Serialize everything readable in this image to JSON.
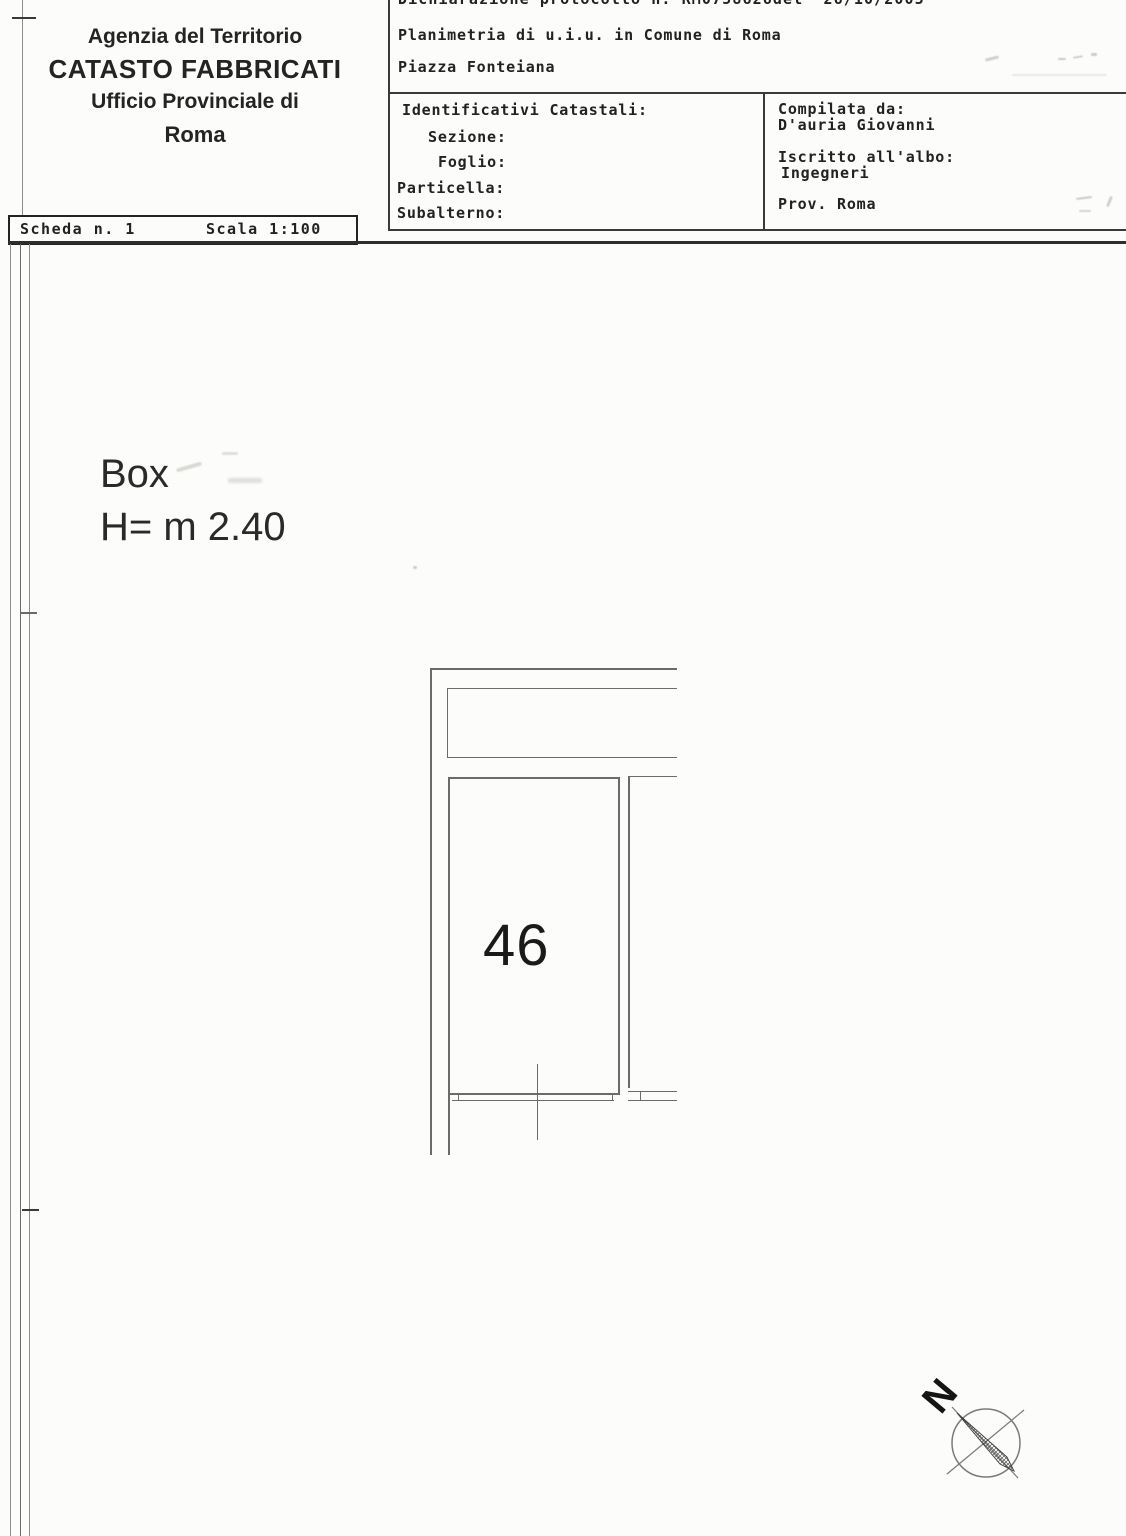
{
  "agency": {
    "line1": "Agenzia del Territorio",
    "line2": "CATASTO FABBRICATI",
    "line3": "Ufficio Provinciale di",
    "line4": "Roma"
  },
  "header": {
    "protocol": "Dichiarazione protocollo n. RM0758626del  26/10/2005",
    "planimetria": "Planimetria di u.i.u. in Comune di Roma",
    "address": "Piazza Fonteiana"
  },
  "identificativi": {
    "title": "Identificativi Catastali:",
    "sezione": "Sezione:",
    "foglio": "Foglio:",
    "particella": "Particella:",
    "subalterno": "Subalterno:"
  },
  "compilata": {
    "title": "Compilata da:",
    "name": "D'auria Giovanni",
    "albo_label": "Iscritto all'albo:",
    "albo_value": "Ingegneri",
    "prov": "Prov. Roma"
  },
  "scheda": {
    "number_label": "Scheda n. 1",
    "scale_label": "Scala 1:100"
  },
  "plan": {
    "room_type_label": "Box",
    "room_height_label": "H= m 2.40",
    "room_number": "46",
    "compass_north": "N"
  },
  "colors": {
    "paper": "#fcfcfa",
    "ink": "#222222",
    "drawing_line": "#6b6b6b",
    "border": "#3a3a3a"
  }
}
